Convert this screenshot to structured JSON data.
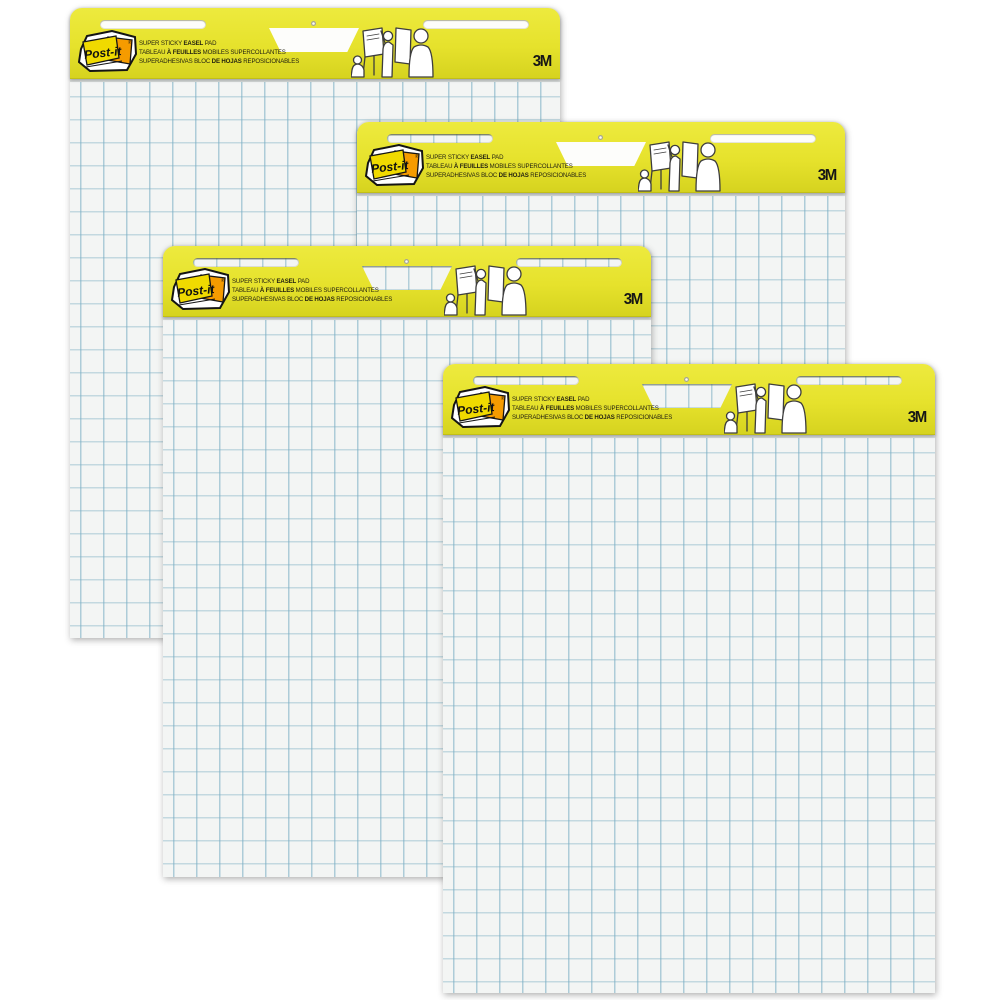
{
  "page": {
    "type": "product-photo",
    "subject": "Four Post-it Super Sticky Easel Pads arranged in an overlapping cascade on a white background",
    "pad_count": 4,
    "background_color": "#ffffff"
  },
  "brand": {
    "name": "Post-it",
    "registered_mark": "®",
    "manufacturer_logo": "3M"
  },
  "header_label": {
    "line1": {
      "pre": "SUPER STICKY ",
      "bold": "EASEL",
      "post": " PAD"
    },
    "line2": {
      "pre": "TABLEAU ",
      "bold": "À FEUILLES",
      "post": " MOBILES SUPERCOLLANTES"
    },
    "line3": {
      "pre": "SUPERADHESIVAS BLOC ",
      "bold": "DE HOJAS",
      "post": " REPOSICIONABLES"
    }
  },
  "colors": {
    "band_yellow": "#e6e22c",
    "note_yellow": "#f0da00",
    "note_orange": "#f59b00",
    "grid_line_blue": "#9fc7d6",
    "paper_white": "#f3f5f4"
  }
}
